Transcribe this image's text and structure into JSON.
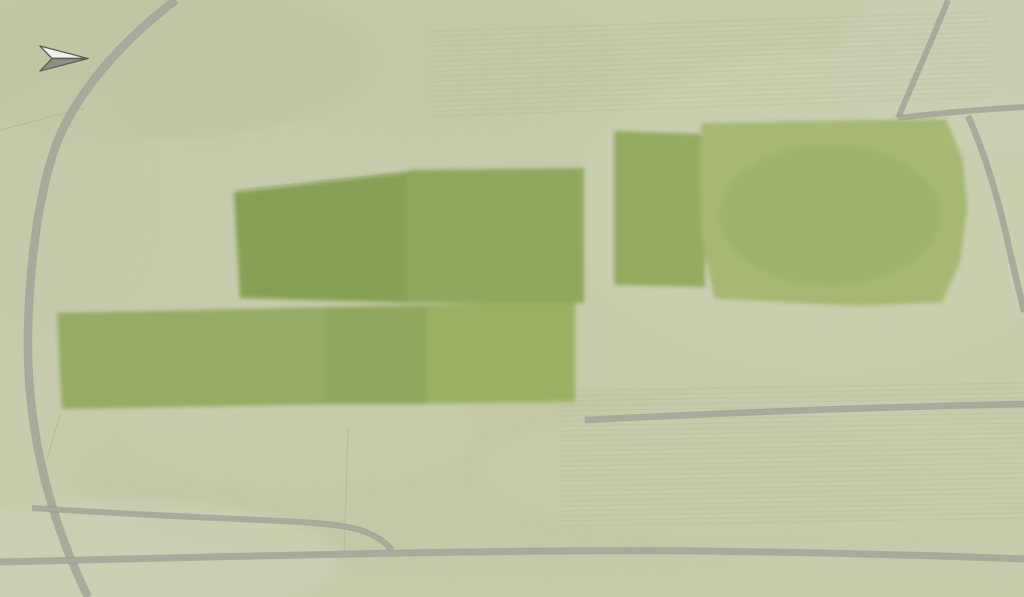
{
  "map": {
    "north_label": "N",
    "plot_count": 18,
    "colors": {
      "field_base": "#c6cbab",
      "development_grass": "#96ab63",
      "paddock_grass": "#85a055",
      "big_field": "#a6b873",
      "plot_outline": "#ffffff",
      "plot_number_text": "#ffffff",
      "internal_road": "#8a7157",
      "public_road": "#a9aa9c",
      "water": "#84a0ad",
      "pond": "#8fb2bc",
      "tree_dark": "#4a6a38",
      "tree_mid": "#6b8f4a",
      "tree_gold": "#a39d52",
      "roof_dark": "#6a645e",
      "roof_tan": "#a89273",
      "roof_light": "#b3aea4",
      "solar_panel": "#39404a",
      "existing_building": "#d8d3b4"
    },
    "plots": [
      {
        "number": "1",
        "cluster": "east",
        "region": {
          "x": 616,
          "y": 133,
          "w": 87,
          "h": 31
        },
        "label": {
          "x": 620,
          "y": 159
        },
        "house_style": "dark"
      },
      {
        "number": "2",
        "cluster": "east",
        "region": {
          "x": 616,
          "y": 164,
          "w": 87,
          "h": 28
        },
        "label": {
          "x": 619,
          "y": 187
        },
        "house_style": "tan"
      },
      {
        "number": "3",
        "cluster": "east",
        "region": {
          "x": 616,
          "y": 192,
          "w": 87,
          "h": 27
        },
        "label": {
          "x": 619,
          "y": 215
        },
        "house_style": "dark"
      },
      {
        "number": "4",
        "cluster": "east",
        "region": {
          "x": 616,
          "y": 219,
          "w": 87,
          "h": 28
        },
        "label": {
          "x": 619,
          "y": 242
        },
        "house_style": "tan"
      },
      {
        "number": "5",
        "cluster": "east",
        "region": {
          "x": 616,
          "y": 247,
          "w": 87,
          "h": 37
        },
        "label": {
          "x": 620,
          "y": 269
        },
        "house_style": "dark"
      },
      {
        "number": "6",
        "cluster": "central",
        "region": {
          "x": 510,
          "y": 173,
          "w": 72,
          "h": 57
        },
        "label": {
          "x": 560,
          "y": 212
        },
        "house_style": "light"
      },
      {
        "number": "7",
        "cluster": "central",
        "region": {
          "x": 510,
          "y": 230,
          "w": 72,
          "h": 40
        },
        "label": {
          "x": 562,
          "y": 256
        },
        "house_style": "light-solar"
      },
      {
        "number": "8",
        "cluster": "central",
        "region": {
          "x": 502,
          "y": 270,
          "w": 80,
          "h": 33
        },
        "label": {
          "x": 557,
          "y": 292
        },
        "house_style": "solar"
      },
      {
        "number": "9",
        "cluster": "central",
        "region": {
          "x": 475,
          "y": 173,
          "w": 35,
          "h": 57
        },
        "label": {
          "x": 486,
          "y": 197
        },
        "house_style": "dark"
      },
      {
        "number": "10",
        "cluster": "central",
        "region": {
          "x": 410,
          "y": 173,
          "w": 65,
          "h": 57
        },
        "label": {
          "x": 414,
          "y": 212
        },
        "house_style": "dark"
      },
      {
        "number": "11",
        "cluster": "central",
        "region": {
          "x": 410,
          "y": 230,
          "w": 65,
          "h": 40
        },
        "label": {
          "x": 414,
          "y": 254
        },
        "house_style": "dark"
      },
      {
        "number": "12",
        "cluster": "central",
        "region": {
          "x": 410,
          "y": 270,
          "w": 73,
          "h": 33
        },
        "label": {
          "x": 414,
          "y": 292
        },
        "house_style": "dark"
      },
      {
        "number": "13",
        "cluster": "south",
        "region": {
          "x": 427,
          "y": 313,
          "w": 116,
          "h": 32
        },
        "label": {
          "x": 431,
          "y": 337
        },
        "house_style": "ghost"
      },
      {
        "number": "14",
        "cluster": "south",
        "region": {
          "x": 427,
          "y": 345,
          "w": 111,
          "h": 30
        },
        "label": {
          "x": 432,
          "y": 367
        },
        "house_style": "solar"
      },
      {
        "number": "15",
        "cluster": "south",
        "region": {
          "x": 427,
          "y": 375,
          "w": 116,
          "h": 30
        },
        "label": {
          "x": 432,
          "y": 396
        },
        "house_style": "dark"
      },
      {
        "number": "16",
        "cluster": "south-west",
        "region": {
          "x": 333,
          "y": 313,
          "w": 80,
          "h": 33
        },
        "label": {
          "x": 393,
          "y": 337
        },
        "house_style": "dark"
      },
      {
        "number": "17",
        "cluster": "south-west",
        "region": {
          "x": 325,
          "y": 346,
          "w": 88,
          "h": 30
        },
        "label": {
          "x": 391,
          "y": 365
        },
        "house_style": "dark"
      },
      {
        "number": "18",
        "cluster": "south-west",
        "region": {
          "x": 325,
          "y": 376,
          "w": 88,
          "h": 28
        },
        "label": {
          "x": 389,
          "y": 395
        },
        "house_style": "dark"
      }
    ]
  }
}
